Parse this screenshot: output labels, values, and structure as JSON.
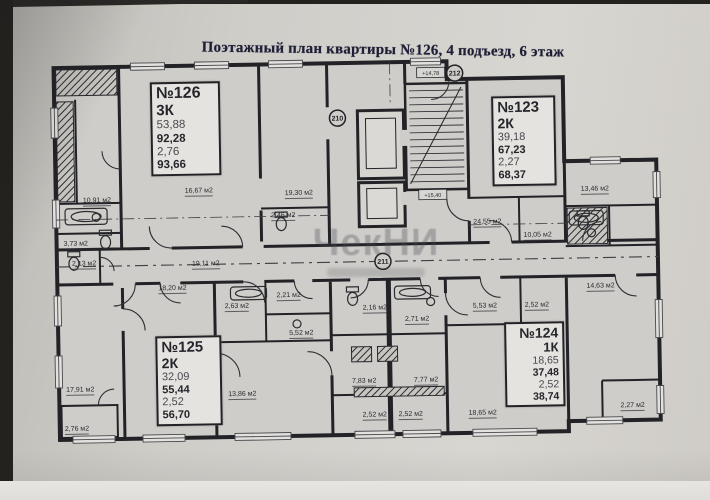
{
  "title": "Поэтажный план квартиры №126, 4 подъезд, 6 этаж",
  "apartments": {
    "a126": {
      "number": "№126",
      "type": "3К",
      "v1": "53,88",
      "v2": "92,28",
      "v3": "2,76",
      "v4": "93,66"
    },
    "a123": {
      "number": "№123",
      "type": "2К",
      "v1": "39,18",
      "v2": "67,23",
      "v3": "2,27",
      "v4": "68,37"
    },
    "a125": {
      "number": "№125",
      "type": "2К",
      "v1": "32,09",
      "v2": "55,44",
      "v3": "2,52",
      "v4": "56,70"
    },
    "a124": {
      "number": "№124",
      "type": "1К",
      "v1": "18,65",
      "v2": "37,48",
      "v3": "2,52",
      "v4": "38,74"
    }
  },
  "rooms": [
    "10,91 м2",
    "3,73 м2",
    "2,13 м2",
    "16,67 м2",
    "19,30 м2",
    "2,46 м2",
    "19,11 м2",
    "24,55 м2",
    "10,05 м2",
    "13,46 м2",
    "14,63 м2",
    "18,20 м2",
    "2,63 м2",
    "2,21 м2",
    "2,16 м2",
    "2,71 м2",
    "5,53 м2",
    "2,52 м2",
    "5,52 м2",
    "17,91 м2",
    "2,76 м2",
    "13,86 м2",
    "7,83 м2",
    "7,77 м2",
    "2,52 м2",
    "2,52 м2",
    "18,65 м2",
    "2,27 м2"
  ],
  "markers": {
    "c210": "210",
    "c211": "211",
    "c212": "212",
    "e1": "+14,78",
    "e2": "+15,40"
  },
  "watermark": {
    "text": "ЧекНИ"
  },
  "colors": {
    "paper": "#cfccc7",
    "ink": "#1c1c22",
    "title_ink": "#1e1e36",
    "photo_edge": "#24221f"
  }
}
